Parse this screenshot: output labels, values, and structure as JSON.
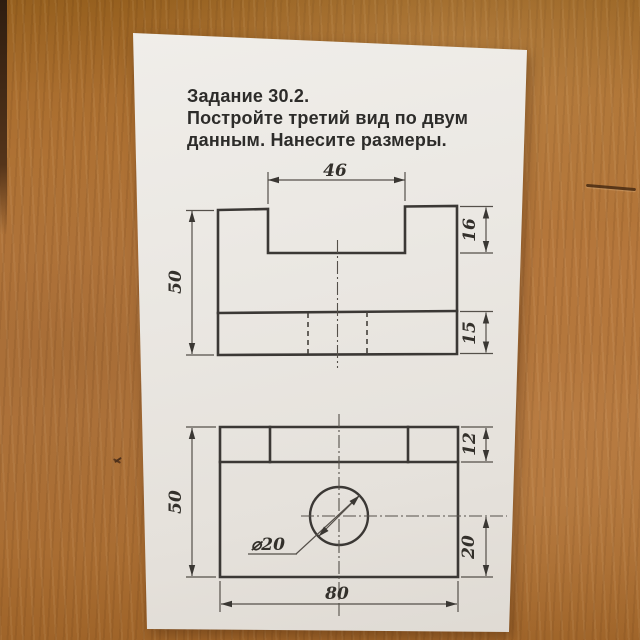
{
  "task": {
    "title": "Задание 30.2.",
    "instruction_line1": "Постройте третий вид по двум",
    "instruction_line2": "данным. Нанесите размеры."
  },
  "front_view": {
    "dim_notch_width": "46",
    "dim_height": "50",
    "dim_notch_depth": "16",
    "dim_base_band": "15"
  },
  "top_view": {
    "dim_depth": "50",
    "dim_top_band": "12",
    "dim_hole_offset": "20",
    "dim_width": "80",
    "dim_hole_diameter": "⌀20"
  },
  "colors": {
    "wood": "#ab6d33",
    "paper": "#ebe8e3",
    "ink": "#3b3835"
  }
}
